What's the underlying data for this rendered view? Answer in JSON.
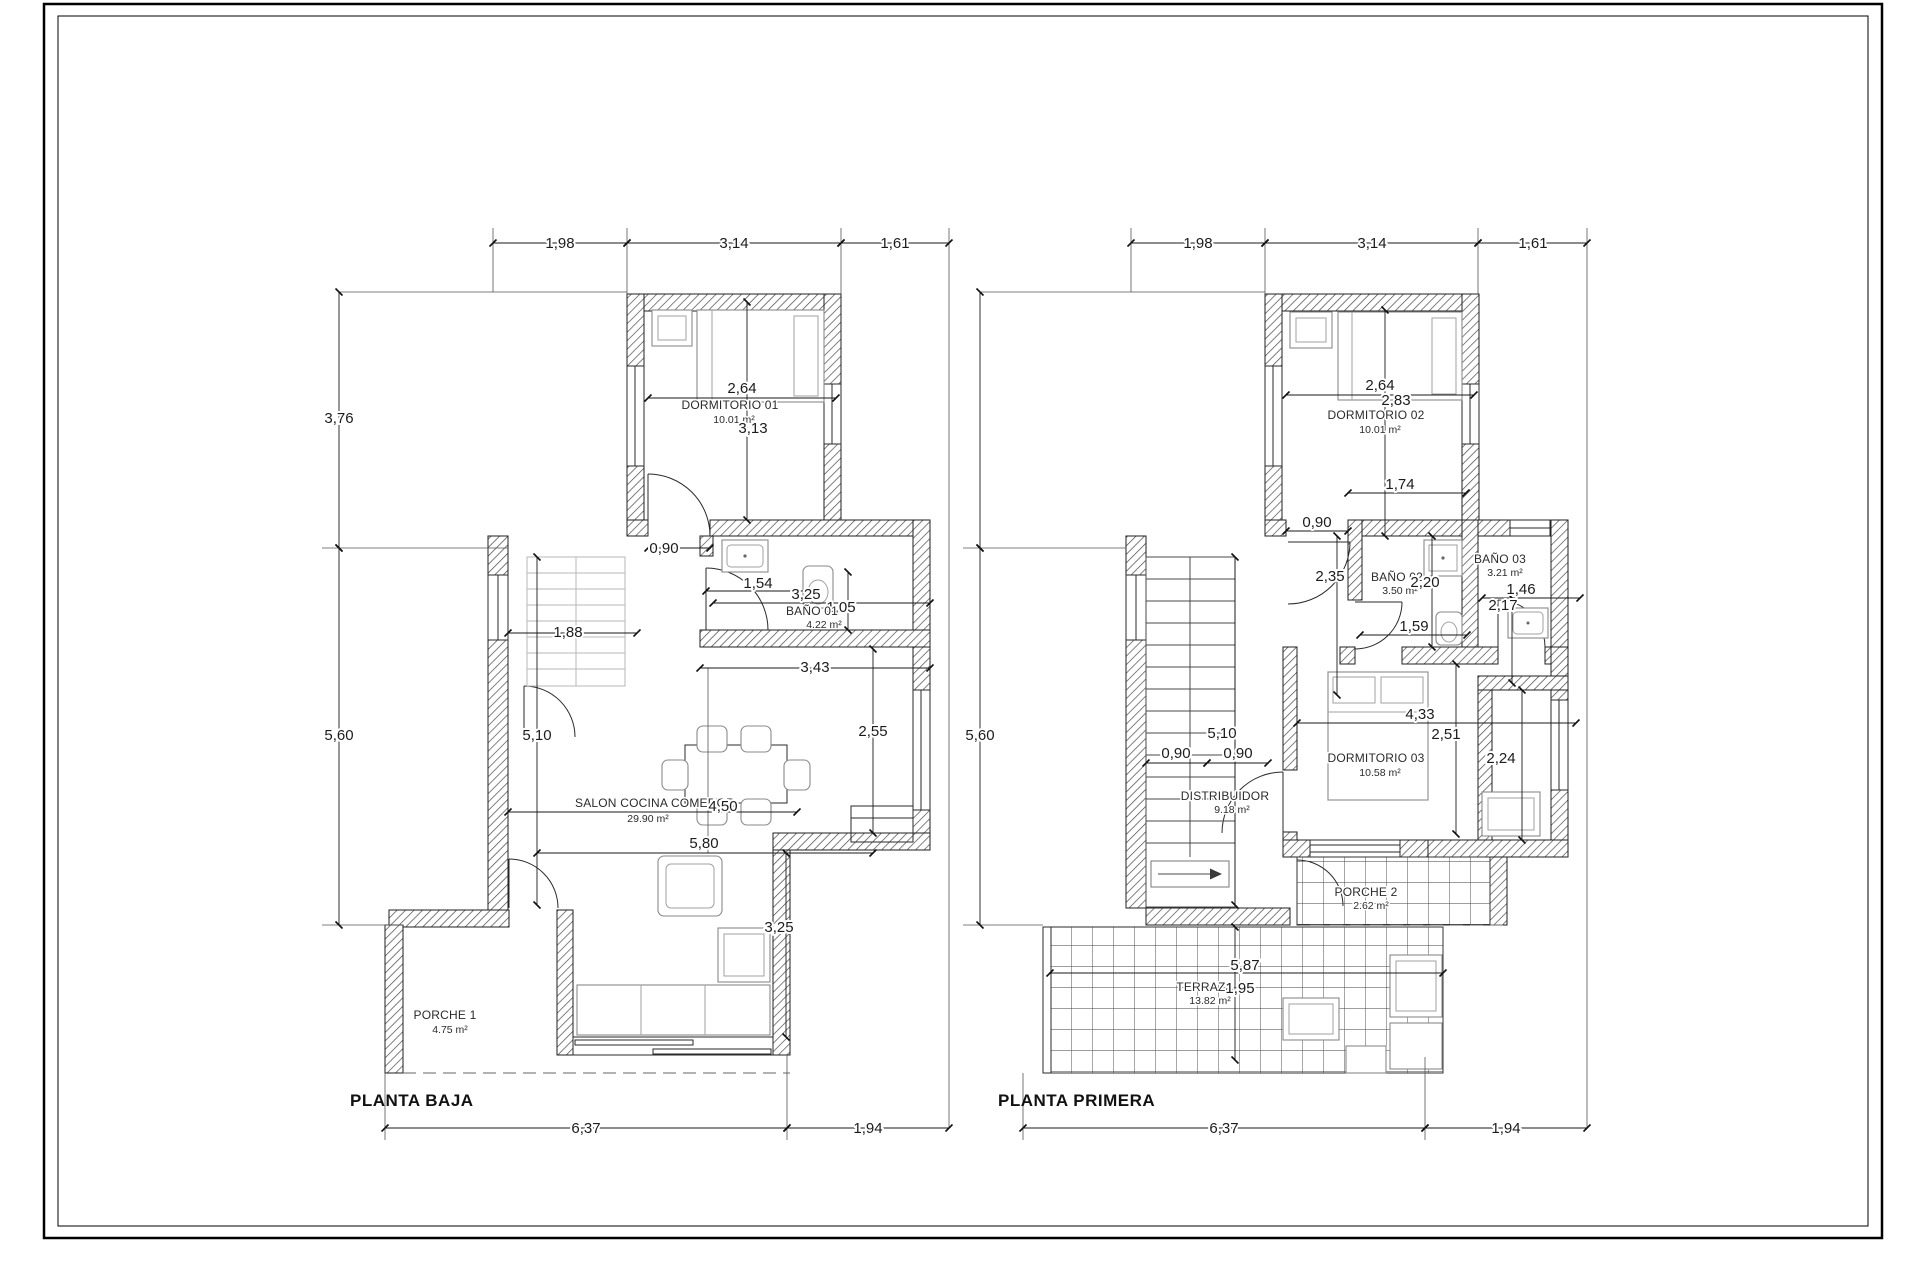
{
  "sheet": {
    "bg": "#ffffff",
    "border_color": "#000000"
  },
  "pb": {
    "title": "PLANTA BAJA",
    "dim_top1": "1,98",
    "dim_top2": "3,14",
    "dim_top3": "1,61",
    "dim_left1": "3,76",
    "dim_left2": "5,60",
    "dim_bot1": "6,37",
    "dim_bot2": "1,94",
    "dorm1_name": "DORMITORIO 01",
    "dorm1_area": "10.01 m²",
    "dorm1_w": "2,64",
    "dorm1_h": "3,13",
    "door": "0,90",
    "hall_w": "1,54",
    "bano_w": "3,25",
    "bano_h": "1,05",
    "bano_name": "BAÑO 01",
    "bano_area": "4.22 m²",
    "stair_w": "1,88",
    "salon_top_w": "3,43",
    "salon_h": "5,10",
    "salon_right_h": "2,55",
    "salon_name": "SALON COCINA COMEDOR",
    "salon_area": "29.90 m²",
    "salon_w": "4,50",
    "sofa_w": "5,80",
    "bay_h": "3,25",
    "porche_name": "PORCHE 1",
    "porche_area": "4.75 m²"
  },
  "pp": {
    "title": "PLANTA PRIMERA",
    "dim_top1": "1,98",
    "dim_top2": "3,14",
    "dim_top3": "1,61",
    "dim_left1": "5,60",
    "dim_bot1": "6,37",
    "dim_bot2": "1,94",
    "dorm2_name": "DORMITORIO 02",
    "dorm2_area": "10.01 m²",
    "dorm2_w": "2,64",
    "dorm2_h": "2,83",
    "closet_w": "1,74",
    "door_top": "0,90",
    "hall_h": "2,35",
    "bano2_name": "BAÑO 02",
    "bano2_area": "3.50 m²",
    "bano2_w": "2,20",
    "bano2_bot": "1,59",
    "bano3_name": "BAÑO 03",
    "bano3_area": "3.21 m²",
    "bano3_w": "1,46",
    "bano3_h": "2,17",
    "dorm3_name": "DORMITORIO 03",
    "dorm3_area": "10.58 m²",
    "dorm3_w": "4,33",
    "dorm3_h": "2,51",
    "closet3_h": "2,24",
    "stair_h": "5,10",
    "door_a": "0,90",
    "door_b": "0,90",
    "dist_name": "DISTRIBUIDOR",
    "dist_area": "9.18 m²",
    "porche_name": "PORCHE 2",
    "porche_area": "2.62 m²",
    "terraza_name": "TERRAZA",
    "terraza_area": "13.82 m²",
    "terraza_w": "5,87",
    "terraza_h": "1,95"
  }
}
